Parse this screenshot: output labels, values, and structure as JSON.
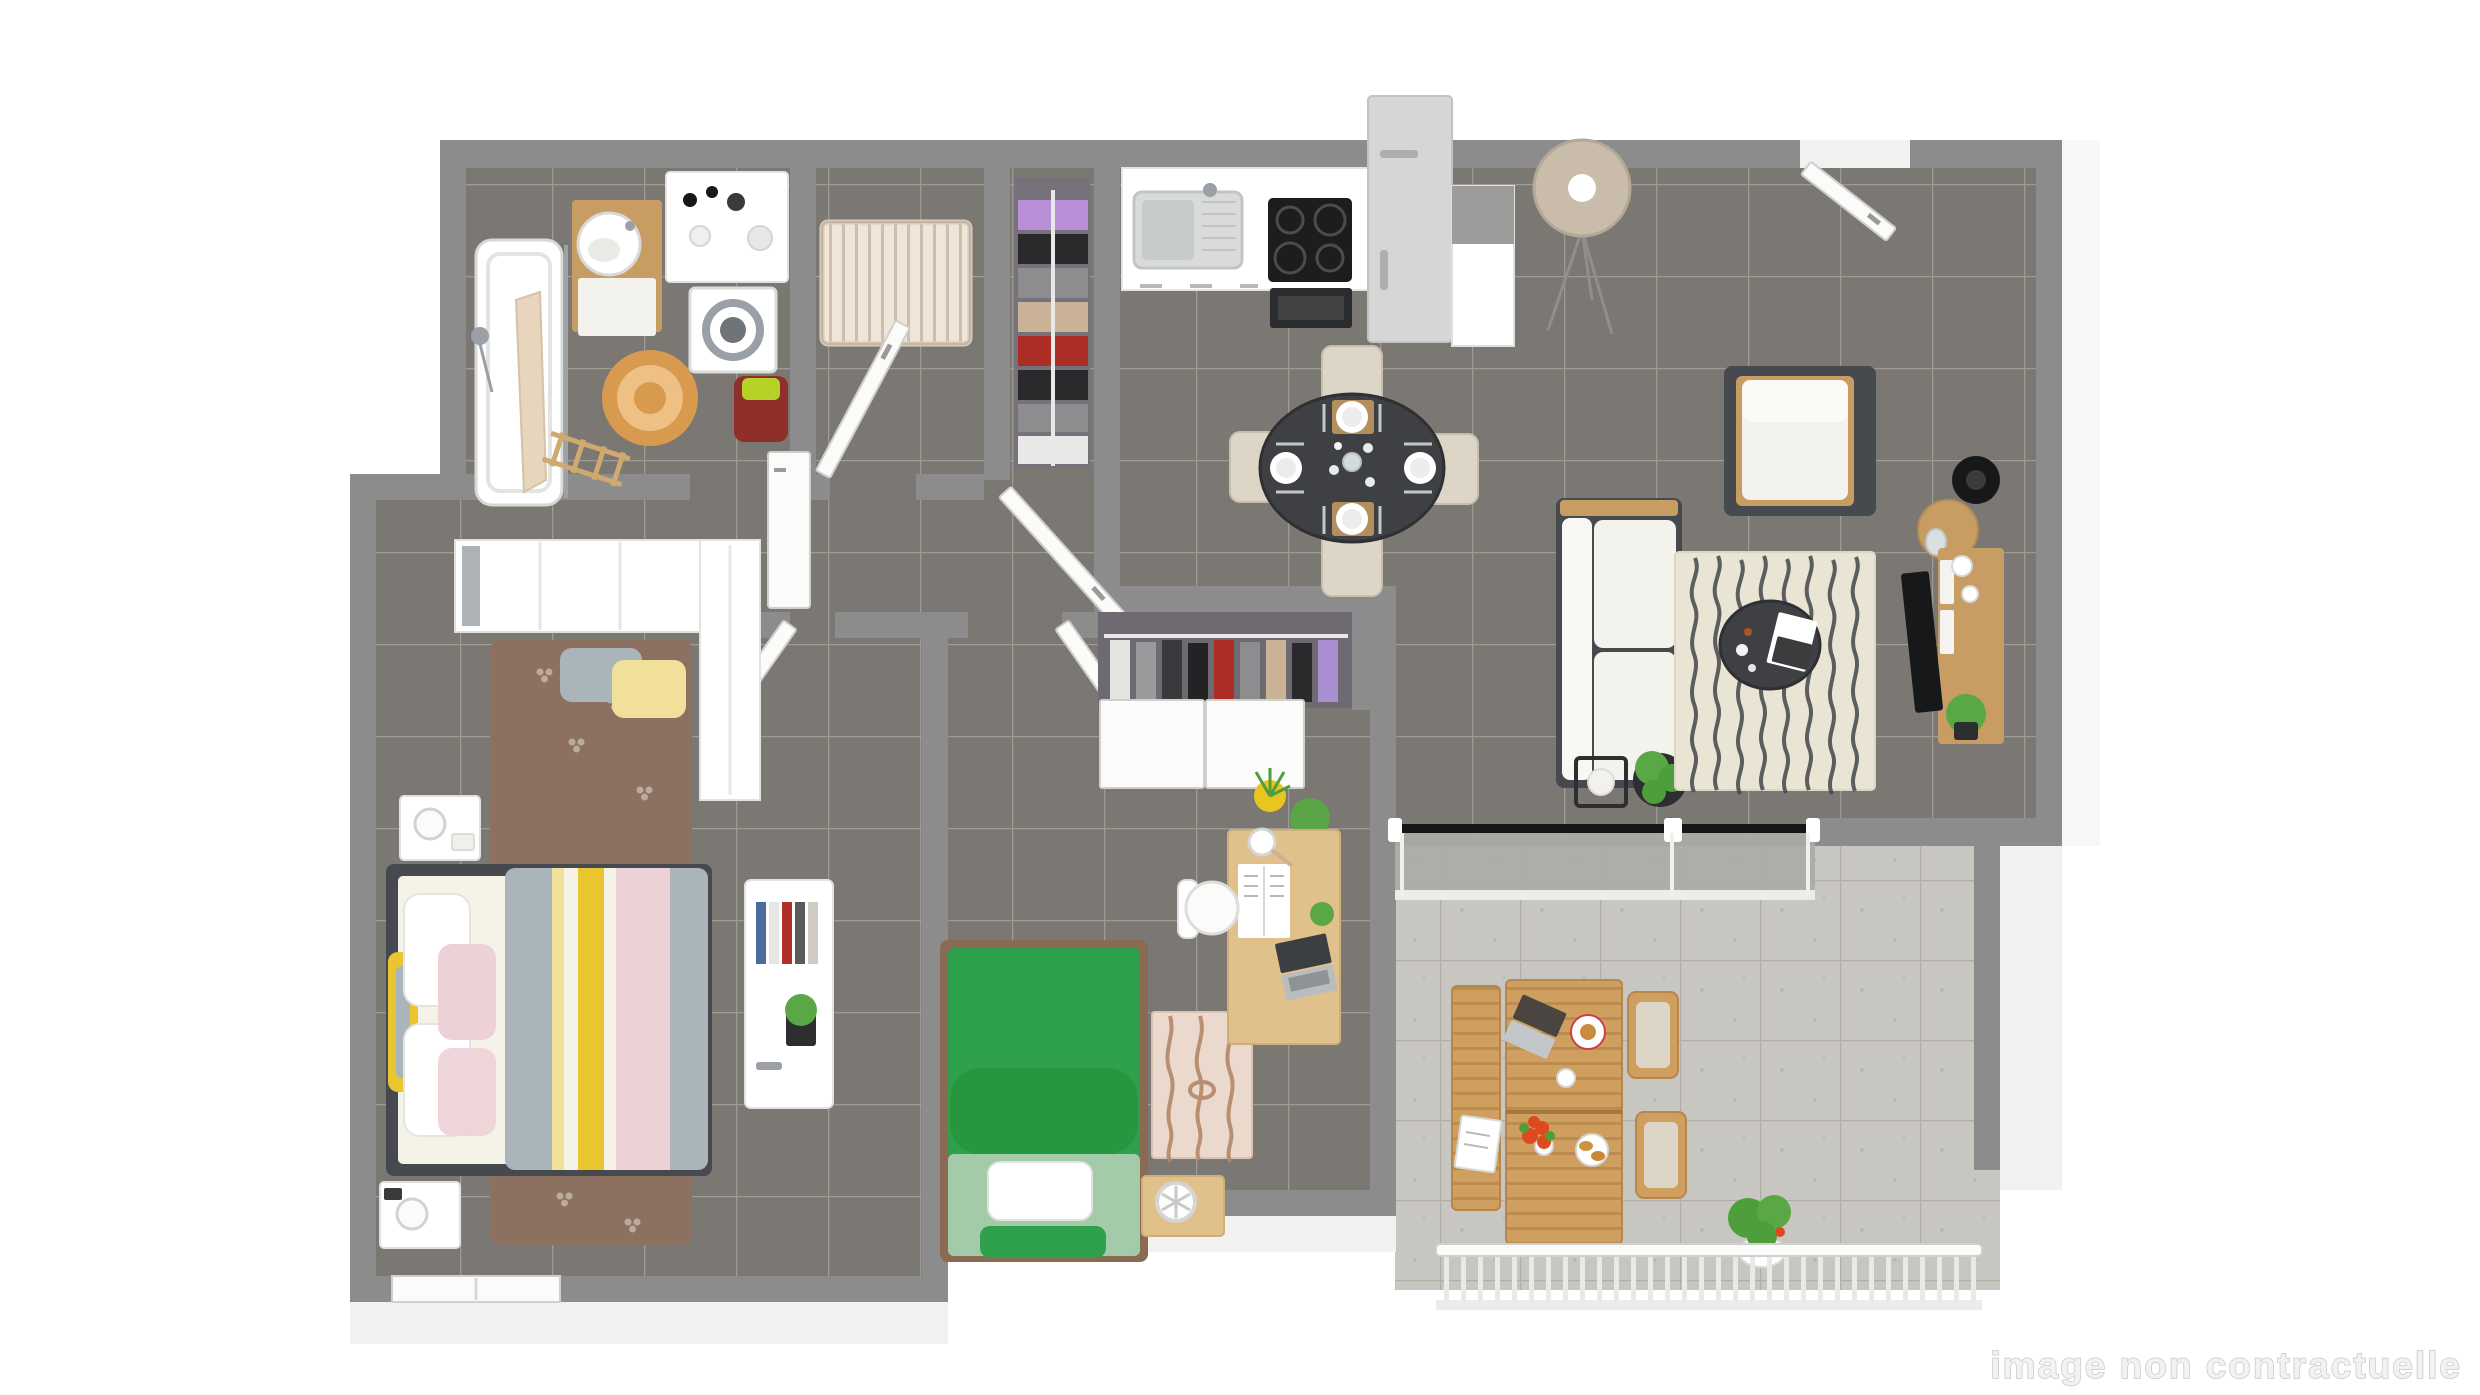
{
  "watermark": {
    "text": "image non contractuelle"
  },
  "palette": {
    "bg": "#ffffff",
    "wall": "#8c8c8c",
    "wallLight": "#f1f1ef",
    "floor": "#7b7874",
    "grout": "#a9a6a0",
    "terraceFloor": "#c8c6c1",
    "terraceGrout": "#aeaba6",
    "white": "#ffffff",
    "offWhite": "#f4f2ec",
    "doorWhite": "#fbfbfa",
    "doorEdge": "#cfcfce",
    "frameDark": "#46494d",
    "tableDark": "#3e4043",
    "black": "#17181a",
    "wood": "#c89d63",
    "woodLight": "#e0c18c",
    "woodTerrace": "#cf9f5f",
    "woodSlat": "#b8864b",
    "cribWood": "#efe6d9",
    "cribSlat": "#cdbfae",
    "bedFrameBrown": "#8a6a52",
    "green": "#2fa14c",
    "greenDark": "#27963f",
    "greenSheet": "#a3cbaa",
    "plantGreen": "#4e9e3c",
    "plantLight": "#5aa845",
    "rugBeige": "#eae4d4",
    "rugSquiggle": "#43464a",
    "rugBrown": "#8c7060",
    "rugPaw": "#c3b6a9",
    "rugCream": "#ead9cc",
    "rugGrain": "#b4886a",
    "jute": "#d79a4e",
    "juteLight": "#eec084",
    "duvetGrey": "#a9b5bb",
    "duvetYellow": "#e9c52f",
    "duvetPaleYellow": "#f0e099",
    "duvetCream": "#f5f2e8",
    "duvetPink": "#ecd2d6",
    "maroon": "#8e2f2a",
    "lime": "#b5d327",
    "appliance": "#d6d6d6",
    "steel": "#9aa0a6",
    "cooktop": "#1c1d1f",
    "chairBeige": "#ddd5c6",
    "chairEdge": "#c7bfae",
    "lampShade": "#c9bcab",
    "glass": "#a9aca6",
    "mirror": "#aeb2b5",
    "closetBack": "#6f6a72",
    "dressingBack": "#77717c",
    "yellowPot": "#e8c51f",
    "orange": "#e0491f",
    "watermarkFill": "#f2f2f2",
    "watermarkStroke": "#c6c6c6"
  },
  "scene": {
    "rooms": [
      {
        "id": "bathroom",
        "furniture": [
          "bathtub",
          "ironing-board",
          "shower-handset",
          "vanity-sink",
          "toiletry-counter",
          "washing-machine",
          "laundry-chair",
          "jute-rug",
          "towel-ladder"
        ]
      },
      {
        "id": "nursery",
        "furniture": [
          "crib",
          "door"
        ]
      },
      {
        "id": "dressing",
        "furniture": [
          "clothes-rail",
          "door"
        ]
      },
      {
        "id": "kitchen",
        "furniture": [
          "counter",
          "sink",
          "cooktop",
          "oven",
          "fridge",
          "island"
        ]
      },
      {
        "id": "dining",
        "furniture": [
          "round-table",
          "chair-north",
          "chair-south",
          "chair-west",
          "chair-east",
          "floor-lamp"
        ]
      },
      {
        "id": "living",
        "furniture": [
          "entry-door",
          "armchair",
          "sofa",
          "rug",
          "coffee-table",
          "plant-stand",
          "plant",
          "side-table",
          "table-lamp",
          "tv-stand",
          "tv",
          "tv-plant"
        ]
      },
      {
        "id": "hallway",
        "furniture": [
          "bedroom-doors",
          "parked-door",
          "entry-closet",
          "sliding-doors"
        ]
      },
      {
        "id": "bedroom-1",
        "furniture": [
          "double-bed",
          "pillows",
          "nightstand-north",
          "nightstand-south",
          "bedside-lamps",
          "rug",
          "floor-cushions",
          "dresser",
          "books",
          "wardrobe",
          "mirror-wardrobe",
          "window"
        ]
      },
      {
        "id": "bedroom-2",
        "furniture": [
          "single-bed",
          "pillow",
          "rug",
          "desk",
          "laptop",
          "magazine",
          "desk-lamp",
          "desk-plant",
          "desk-chair",
          "side-table",
          "fan",
          "potted-plants"
        ]
      },
      {
        "id": "terrace",
        "furniture": [
          "sliding-glass-door",
          "outdoor-table",
          "bench",
          "chair-1",
          "chair-2",
          "laptop",
          "plates",
          "flower-vase",
          "magazine",
          "railing",
          "potted-plant"
        ]
      }
    ],
    "dressing_clothes": [
      "#b88fd6",
      "#2a2a2c",
      "#8d8d8f",
      "#c9b295",
      "#ab2d26",
      "#2a2a2c",
      "#8d8d8f",
      "#e8e8e8"
    ],
    "closet_clothes": [
      "#e3e3e1",
      "#9a9a9c",
      "#3a3a3c",
      "#232325",
      "#ab2d26",
      "#8d8d8f",
      "#c9b295",
      "#2a2a2c",
      "#a98fd0"
    ],
    "duvet_stripes": [
      "#a9b5bb",
      "#f0e099",
      "#f5f2e8",
      "#e9c52f",
      "#f5f2e8",
      "#ecd2d6",
      "#a9b5bb"
    ],
    "book_colors": [
      "#4a6b9c",
      "#e6e6e4",
      "#b03028",
      "#5a5a5c",
      "#cfcac2"
    ]
  }
}
